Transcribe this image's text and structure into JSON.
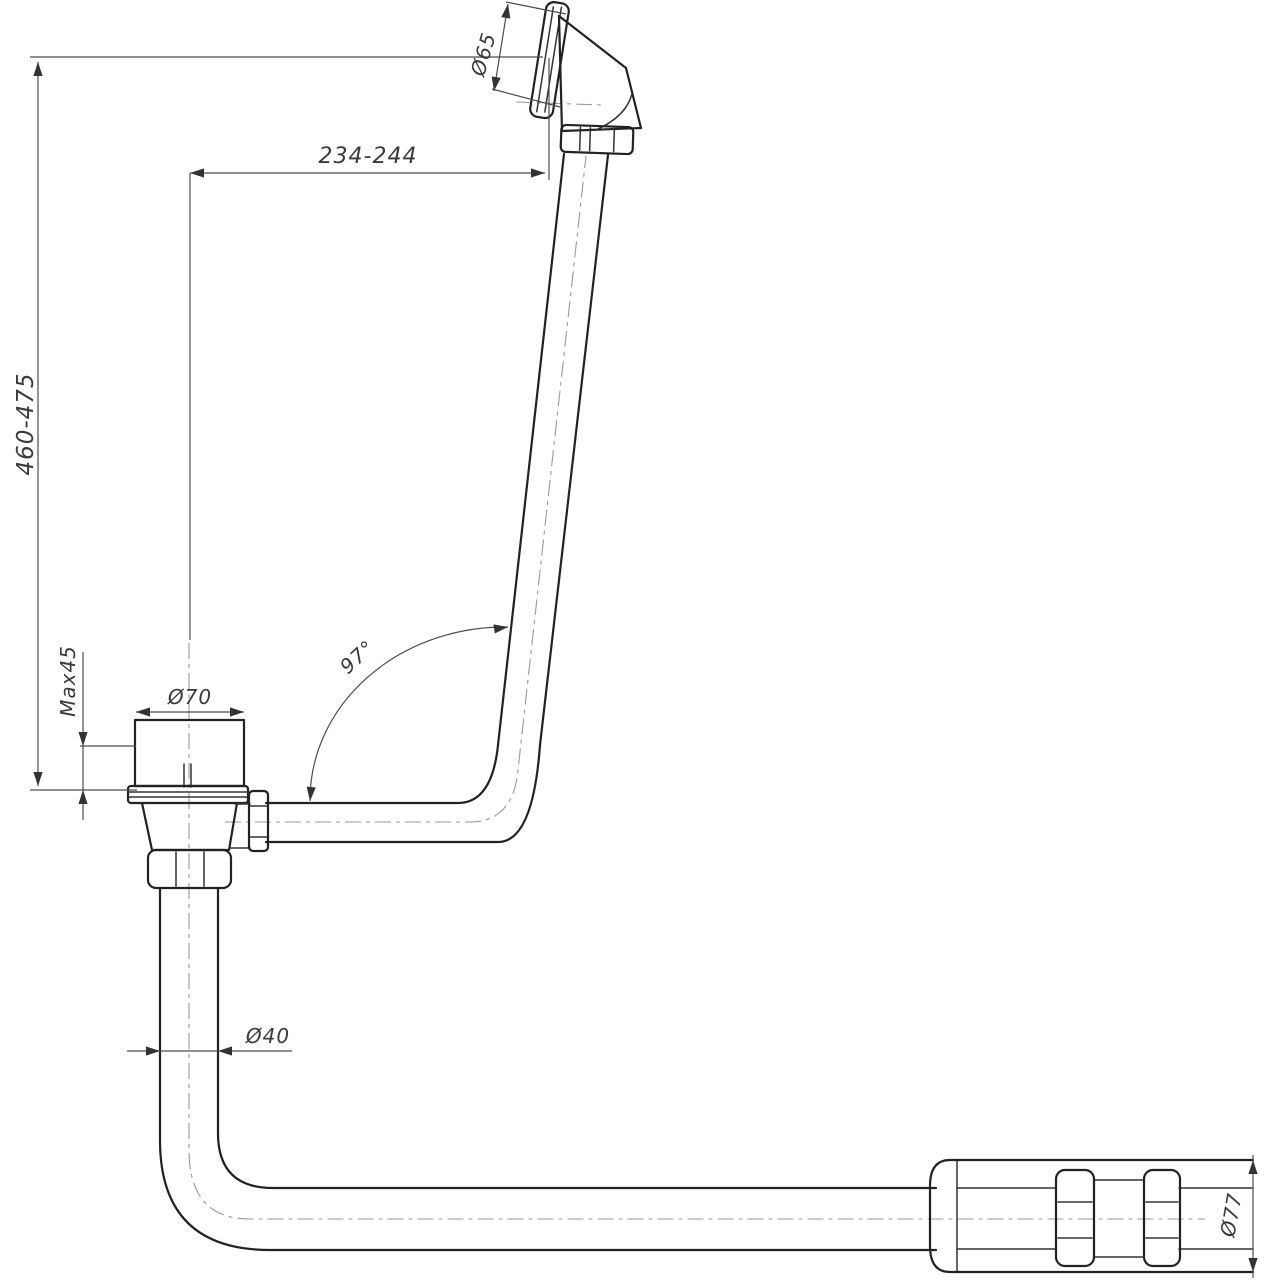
{
  "drawing": {
    "type": "technical-drawing",
    "subject": "bath-waste-overflow-drain-assembly",
    "line_color": "#222222",
    "dimension_color": "#4d4d4d",
    "background": "#ffffff",
    "labels": {
      "height_range": "460-475",
      "max_thickness": "Max45",
      "width_range": "234-244",
      "overflow_diameter": "Ø65",
      "waste_diameter": "Ø70",
      "bend_angle": "97°",
      "pipe_diameter": "Ø40",
      "coupling_diameter": "Ø77"
    }
  }
}
